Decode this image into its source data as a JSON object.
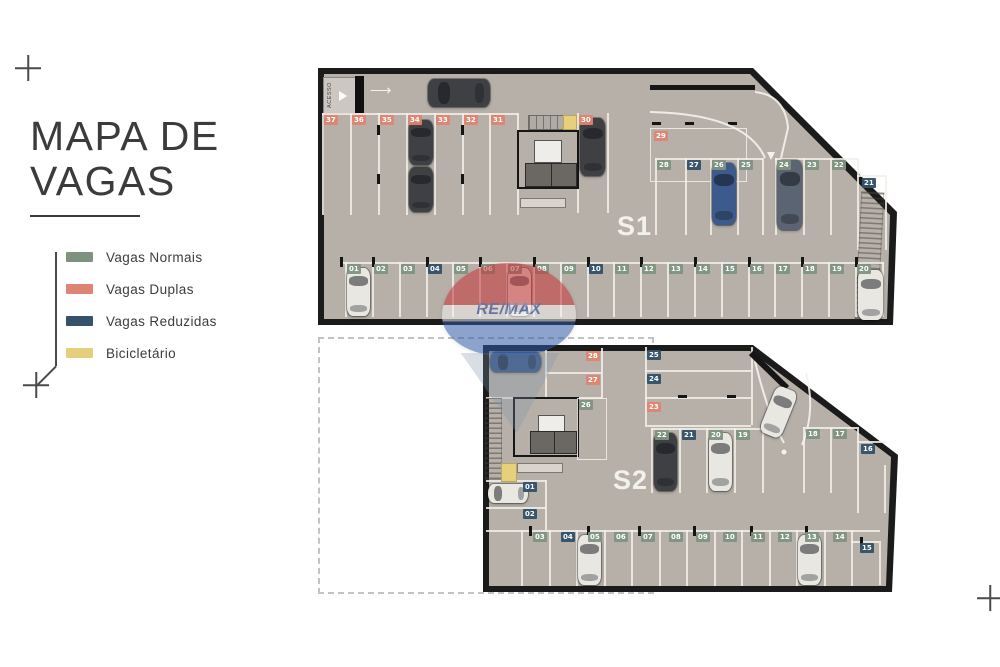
{
  "title": {
    "line1": "MAPA DE",
    "line2": "VAGAS"
  },
  "legend": {
    "items": [
      {
        "label": "Vagas Normais",
        "color": "#7e937f",
        "type": "normal"
      },
      {
        "label": "Vagas Duplas",
        "color": "#df8470",
        "type": "dupla"
      },
      {
        "label": "Vagas Reduzidas",
        "color": "#35526a",
        "type": "reduzida"
      },
      {
        "label": "Bicicletário",
        "color": "#e5cf7d",
        "type": "bike"
      }
    ]
  },
  "watermark": {
    "brand": "RE/MAX"
  },
  "s1": {
    "label": "S1",
    "access_label": "ACESSO",
    "top_row": [
      {
        "num": "37",
        "type": "dupla"
      },
      {
        "num": "36",
        "type": "dupla"
      },
      {
        "num": "35",
        "type": "dupla"
      },
      {
        "num": "34",
        "type": "dupla"
      },
      {
        "num": "33",
        "type": "dupla"
      },
      {
        "num": "32",
        "type": "dupla"
      },
      {
        "num": "31",
        "type": "dupla"
      },
      {
        "num": "30",
        "type": "dupla"
      }
    ],
    "spot29": {
      "num": "29",
      "type": "dupla"
    },
    "mid_row": [
      {
        "num": "28",
        "type": "normal"
      },
      {
        "num": "27",
        "type": "reduzida"
      },
      {
        "num": "26",
        "type": "normal"
      },
      {
        "num": "25",
        "type": "normal"
      },
      {
        "num": "24",
        "type": "normal"
      },
      {
        "num": "23",
        "type": "normal"
      },
      {
        "num": "22",
        "type": "normal"
      },
      {
        "num": "21",
        "type": "reduzida"
      }
    ],
    "bottom_row": [
      {
        "num": "01",
        "type": "normal"
      },
      {
        "num": "02",
        "type": "normal"
      },
      {
        "num": "03",
        "type": "normal"
      },
      {
        "num": "04",
        "type": "reduzida"
      },
      {
        "num": "05",
        "type": "normal"
      },
      {
        "num": "06",
        "type": "normal"
      },
      {
        "num": "07",
        "type": "normal"
      },
      {
        "num": "08",
        "type": "normal"
      },
      {
        "num": "09",
        "type": "normal"
      },
      {
        "num": "10",
        "type": "reduzida"
      },
      {
        "num": "11",
        "type": "normal"
      },
      {
        "num": "12",
        "type": "normal"
      },
      {
        "num": "13",
        "type": "normal"
      },
      {
        "num": "14",
        "type": "normal"
      },
      {
        "num": "15",
        "type": "normal"
      },
      {
        "num": "16",
        "type": "normal"
      },
      {
        "num": "17",
        "type": "normal"
      },
      {
        "num": "18",
        "type": "normal"
      },
      {
        "num": "19",
        "type": "normal"
      },
      {
        "num": "20",
        "type": "normal"
      }
    ]
  },
  "s2": {
    "label": "S2",
    "top_left": [
      {
        "num": "28",
        "type": "dupla"
      },
      {
        "num": "27",
        "type": "dupla"
      }
    ],
    "spot26": {
      "num": "26",
      "type": "normal"
    },
    "left_col": [
      {
        "num": "01",
        "type": "reduzida"
      },
      {
        "num": "02",
        "type": "reduzida"
      }
    ],
    "right_top": [
      {
        "num": "25",
        "type": "reduzida"
      },
      {
        "num": "24",
        "type": "reduzida"
      },
      {
        "num": "23",
        "type": "dupla"
      }
    ],
    "mid_row": [
      {
        "num": "22",
        "type": "normal"
      },
      {
        "num": "21",
        "type": "reduzida"
      },
      {
        "num": "20",
        "type": "normal"
      },
      {
        "num": "19",
        "type": "normal"
      },
      {
        "num": "18",
        "type": "normal"
      },
      {
        "num": "17",
        "type": "normal"
      },
      {
        "num": "16",
        "type": "reduzida"
      }
    ],
    "bottom_row": [
      {
        "num": "03",
        "type": "normal"
      },
      {
        "num": "04",
        "type": "reduzida"
      },
      {
        "num": "05",
        "type": "normal"
      },
      {
        "num": "06",
        "type": "normal"
      },
      {
        "num": "07",
        "type": "normal"
      },
      {
        "num": "08",
        "type": "normal"
      },
      {
        "num": "09",
        "type": "normal"
      },
      {
        "num": "10",
        "type": "normal"
      },
      {
        "num": "11",
        "type": "normal"
      },
      {
        "num": "12",
        "type": "normal"
      },
      {
        "num": "13",
        "type": "normal"
      },
      {
        "num": "14",
        "type": "normal"
      },
      {
        "num": "15",
        "type": "reduzida"
      }
    ]
  }
}
